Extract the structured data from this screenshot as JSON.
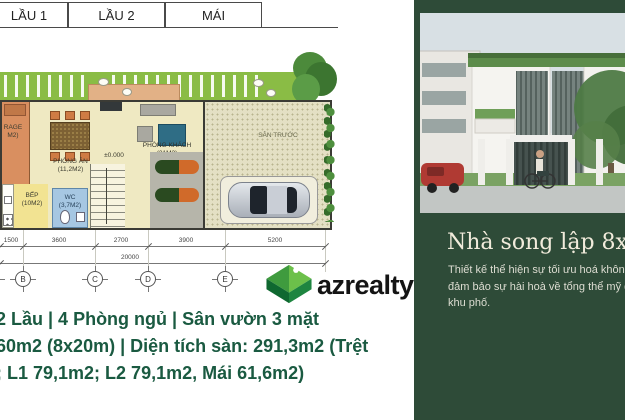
{
  "tabs": {
    "items": [
      {
        "label": "LẦU 1"
      },
      {
        "label": "LẦU 2"
      },
      {
        "label": "MÁI"
      }
    ]
  },
  "plan": {
    "rooms": {
      "garage": {
        "line1": "RAGE",
        "line2": "M2)"
      },
      "dining": {
        "name": "PHÒNG ĂN",
        "area": "(11,2M2)"
      },
      "living": {
        "name": "PHÒNG KHÁCH",
        "area": "(21M2)"
      },
      "kitchen": {
        "name": "BẾP",
        "area": "(10M2)"
      },
      "wc": {
        "name": "WC",
        "area": "(3,7M2)"
      },
      "front_yard": {
        "name": "SÂN TRƯỚC"
      }
    },
    "level_marker": "±0.000",
    "dimensions": {
      "segments": [
        "1500",
        "3600",
        "2700",
        "3900",
        "5200"
      ],
      "total": "20000"
    },
    "grid_labels": [
      "B",
      "C",
      "D",
      "E"
    ]
  },
  "logo": {
    "text": "azrealty",
    "colors": {
      "light": "#6cc04a",
      "mid": "#3f9b3e",
      "dark_left": "#0f6830",
      "dark_right": "#1e8540"
    }
  },
  "summary": {
    "color": "#1a5a41",
    "lines": [
      "2 Lầu | 4 Phòng ngủ | Sân vườn 3 mặt",
      "60m2 (8x20m) | Diện tích sàn: 291,3m2 (Trệt",
      "; L1 79,1m2; L2 79,1m2, Mái 61,6m2)"
    ]
  },
  "panel": {
    "bg": "#2e4b38",
    "title": "Nhà song lập 8x20",
    "description_lines": [
      "Thiết kế thể hiện sự tối ưu hoá không",
      "đảm bảo sự hài hoà về tổng thể mỹ qu",
      "khu phố."
    ]
  }
}
